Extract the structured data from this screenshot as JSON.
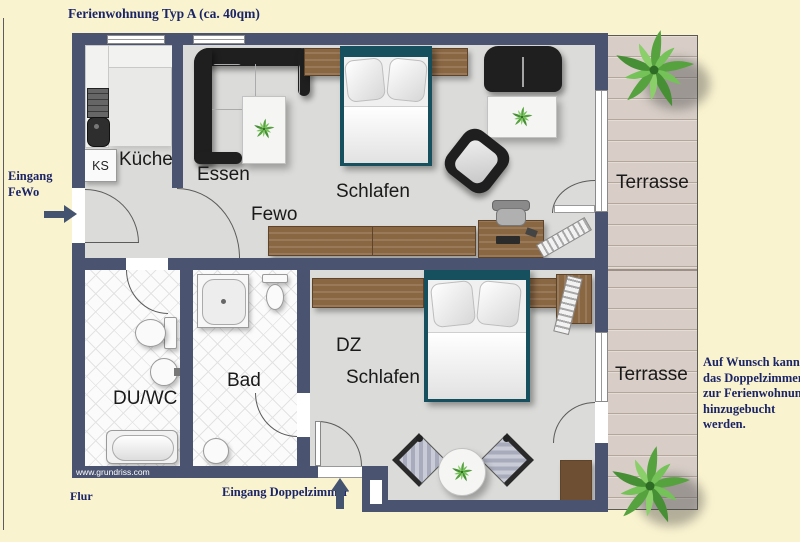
{
  "title": "Ferienwohnung Typ A (ca. 40qm)",
  "annotations": {
    "entrance_fewo": [
      "Eingang",
      "FeWo"
    ],
    "flur": "Flur",
    "entrance_dz": "Eingang Doppelzimmer",
    "note": [
      "Auf Wunsch kann",
      "das Doppelzimmer",
      "zur Ferienwohnung",
      "hinzugebucht",
      "werden."
    ],
    "watermark": "www.grundriss.com"
  },
  "rooms": {
    "kueche": "Küche",
    "essen": "Essen",
    "fewo": "Fewo",
    "schlafen": "Schlafen",
    "terrasse_top": "Terrasse",
    "du_wc": "DU/WC",
    "bad": "Bad",
    "dz": "DZ",
    "dz_schlafen": "Schlafen",
    "terrasse_bottom": "Terrasse",
    "ks": "KS"
  },
  "colors": {
    "background": "#FAF3D0",
    "wall": "#4A5470",
    "floor": "#DBDBD9",
    "terrace_deck": "#D8CEC7",
    "wood": "#8A6743",
    "bed_frame": "#16505E",
    "text_navy": "#1B2566",
    "label_black": "#1A1A1A"
  }
}
